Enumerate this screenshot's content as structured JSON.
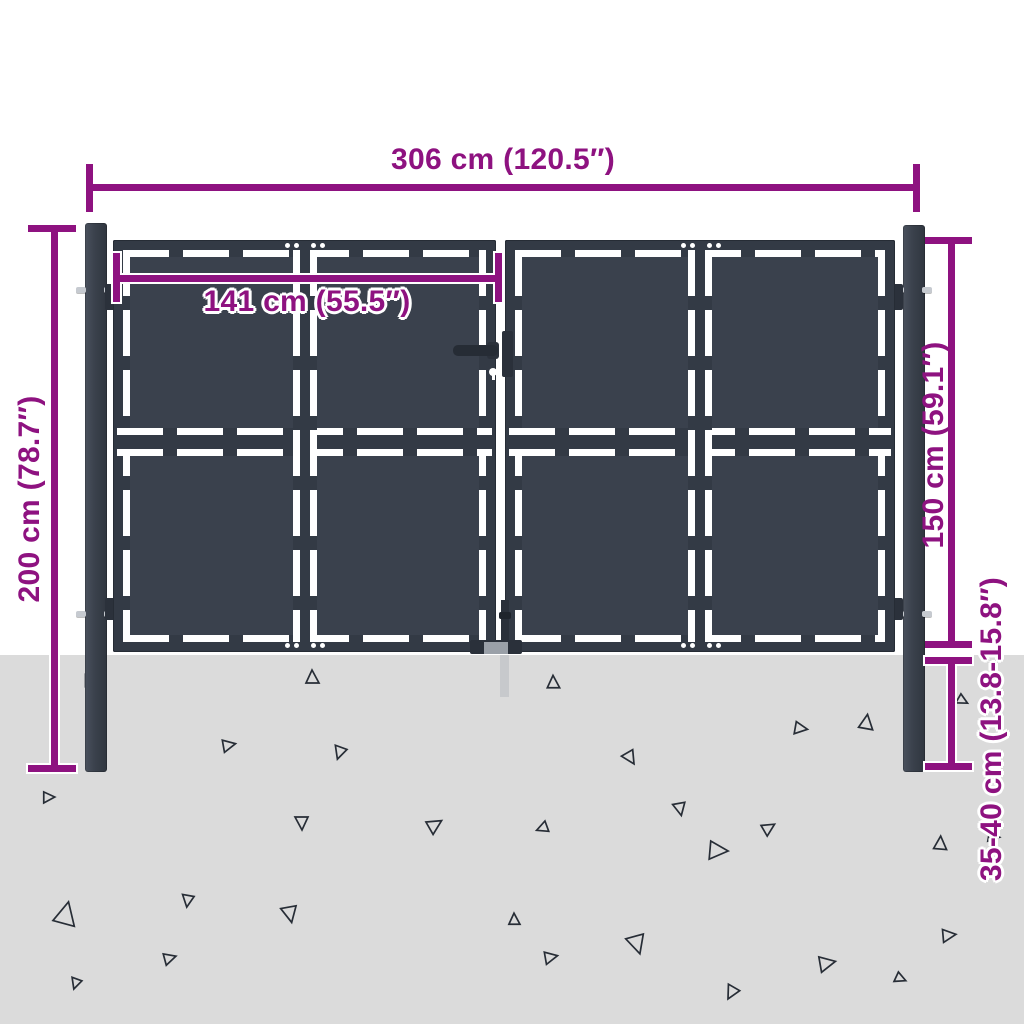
{
  "diagram": {
    "type": "product-dimension-diagram",
    "subject": "double garden gate with posts, anthracite steel"
  },
  "labels": {
    "total_width": "306 cm (120.5″)",
    "leaf_width": "141 cm (55.5″)",
    "post_height": "200 cm (78.7″)",
    "gate_height": "150 cm (59.1″)",
    "ground_depth": "35-40 cm (13.8-15.8″)"
  },
  "colors": {
    "dimension_accent": "#8E1280",
    "gate_frame": "#333A45",
    "gate_panel": "#3A414D",
    "post": "#3A414C",
    "ground": "#DBDBDB",
    "background": "#FFFFFF"
  }
}
